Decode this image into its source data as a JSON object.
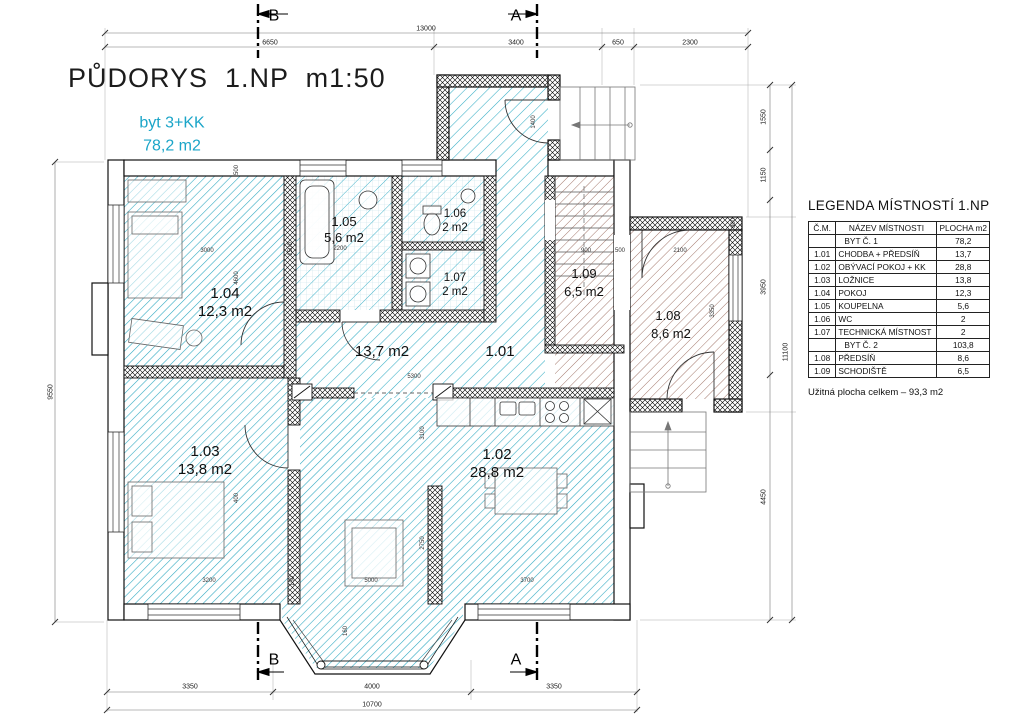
{
  "title": "PŮDORYS  1.NP  m1:50",
  "apartment": {
    "type": "byt 3+KK",
    "area": "78,2 m2"
  },
  "section_markers": {
    "b": "B",
    "a": "A"
  },
  "colors": {
    "accent_cyan": "#1ba5c8",
    "hatch_cyan": "#36aec6",
    "hatch_brown": "#a3786c"
  },
  "rooms": [
    {
      "id": "1.01",
      "area": "13,7 m2"
    },
    {
      "id": "1.02",
      "area": "28,8 m2"
    },
    {
      "id": "1.03",
      "area": "13,8 m2"
    },
    {
      "id": "1.04",
      "area": "12,3 m2"
    },
    {
      "id": "1.05",
      "area": "5,6 m2"
    },
    {
      "id": "1.06",
      "area": "2 m2"
    },
    {
      "id": "1.07",
      "area": "2 m2"
    },
    {
      "id": "1.08",
      "area": "8,6 m2"
    },
    {
      "id": "1.09",
      "area": "6,5 m2"
    }
  ],
  "dimensions": {
    "top_total": "13000",
    "top": [
      "6650",
      "3400",
      "650",
      "2300"
    ],
    "bottom": [
      "3350",
      "4000",
      "3350"
    ],
    "bottom_total": "10700",
    "left_total": "9550",
    "right": [
      "1550",
      "1150",
      "3950",
      "4450"
    ],
    "right_total": "11100",
    "internal": [
      "500",
      "3000",
      "4600",
      "1500",
      "2200",
      "1400",
      "5300",
      "3200",
      "150",
      "5000",
      "3700",
      "2750",
      "3100",
      "400",
      "900",
      "2100",
      "3350",
      "300",
      "160",
      "500"
    ]
  },
  "legend": {
    "title": "LEGENDA MÍSTNOSTÍ 1.NP",
    "columns": [
      "Č.M.",
      "NÁZEV MÍSTNOSTI",
      "PLOCHA m2"
    ],
    "rows": [
      {
        "cm": "",
        "name": "BYT Č. 1",
        "area": "78,2"
      },
      {
        "cm": "1.01",
        "name": "CHODBA + PŘEDSÍŇ",
        "area": "13,7"
      },
      {
        "cm": "1.02",
        "name": "OBÝVACÍ POKOJ + KK",
        "area": "28,8"
      },
      {
        "cm": "1.03",
        "name": "LOŽNICE",
        "area": "13,8"
      },
      {
        "cm": "1.04",
        "name": "POKOJ",
        "area": "12,3"
      },
      {
        "cm": "1.05",
        "name": "KOUPELNA",
        "area": "5,6"
      },
      {
        "cm": "1.06",
        "name": "WC",
        "area": "2"
      },
      {
        "cm": "1.07",
        "name": "TECHNICKÁ MÍSTNOST",
        "area": "2"
      },
      {
        "cm": "",
        "name": "BYT Č. 2",
        "area": "103,8"
      },
      {
        "cm": "1.08",
        "name": "PŘEDSÍŇ",
        "area": "8,6"
      },
      {
        "cm": "1.09",
        "name": "SCHODIŠTĚ",
        "area": "6,5"
      }
    ],
    "footer": "Užitná plocha celkem – 93,3 m2"
  }
}
